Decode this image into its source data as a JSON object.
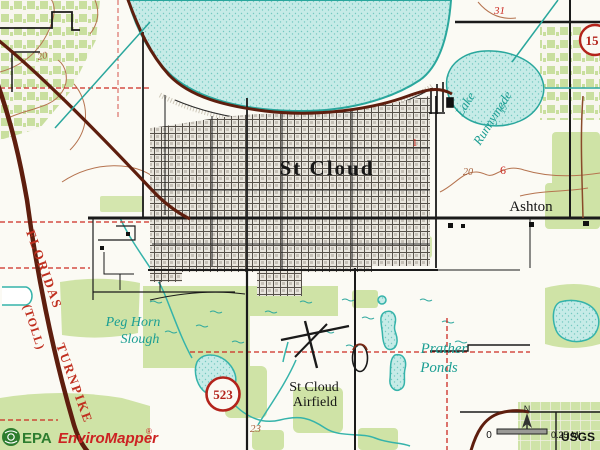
{
  "map_labels": {
    "city": "St Cloud",
    "district": "Ashton",
    "lake_line1": "Lake",
    "lake_line2": "Runnymede",
    "lake_depth": "17",
    "slough_line1": "Peg Horn",
    "slough_line2": "Slough",
    "ponds_line1": "Prather",
    "ponds_line2": "Ponds",
    "airfield_line1": "St Cloud",
    "airfield_line2": "Airfield"
  },
  "turnpike": {
    "line1": "FLORIDAS",
    "line2": "(TOLL)",
    "line3": "TURNPIKE"
  },
  "route_shields": {
    "county_523": "523",
    "state_15": "15"
  },
  "map_numbers": {
    "contour_nw": "20",
    "contour_east": "20",
    "red_6": "6",
    "red_1": "1",
    "red_31": "31",
    "section_23": "23"
  },
  "branding": {
    "epa": "EPA",
    "product": "EnviroMapper",
    "registered": "®"
  },
  "scale": {
    "zero": "0",
    "distance": "0.25 Mi",
    "attribution": "USGS",
    "north": "N"
  },
  "colors": {
    "water_fill": "#c6ebe7",
    "water_line": "#2aa79d",
    "vegetation": "#cfe3a6",
    "road_major_maroon": "#5e1e0e",
    "road_black": "#1a1a1a",
    "contour_brown": "#b5734f",
    "section_red": "#cc2a22",
    "water_label": "#1b9e93",
    "turnpike_label_red": "#c03020",
    "epa_green": "#2d7d2f",
    "brand_red": "#cc2222"
  }
}
